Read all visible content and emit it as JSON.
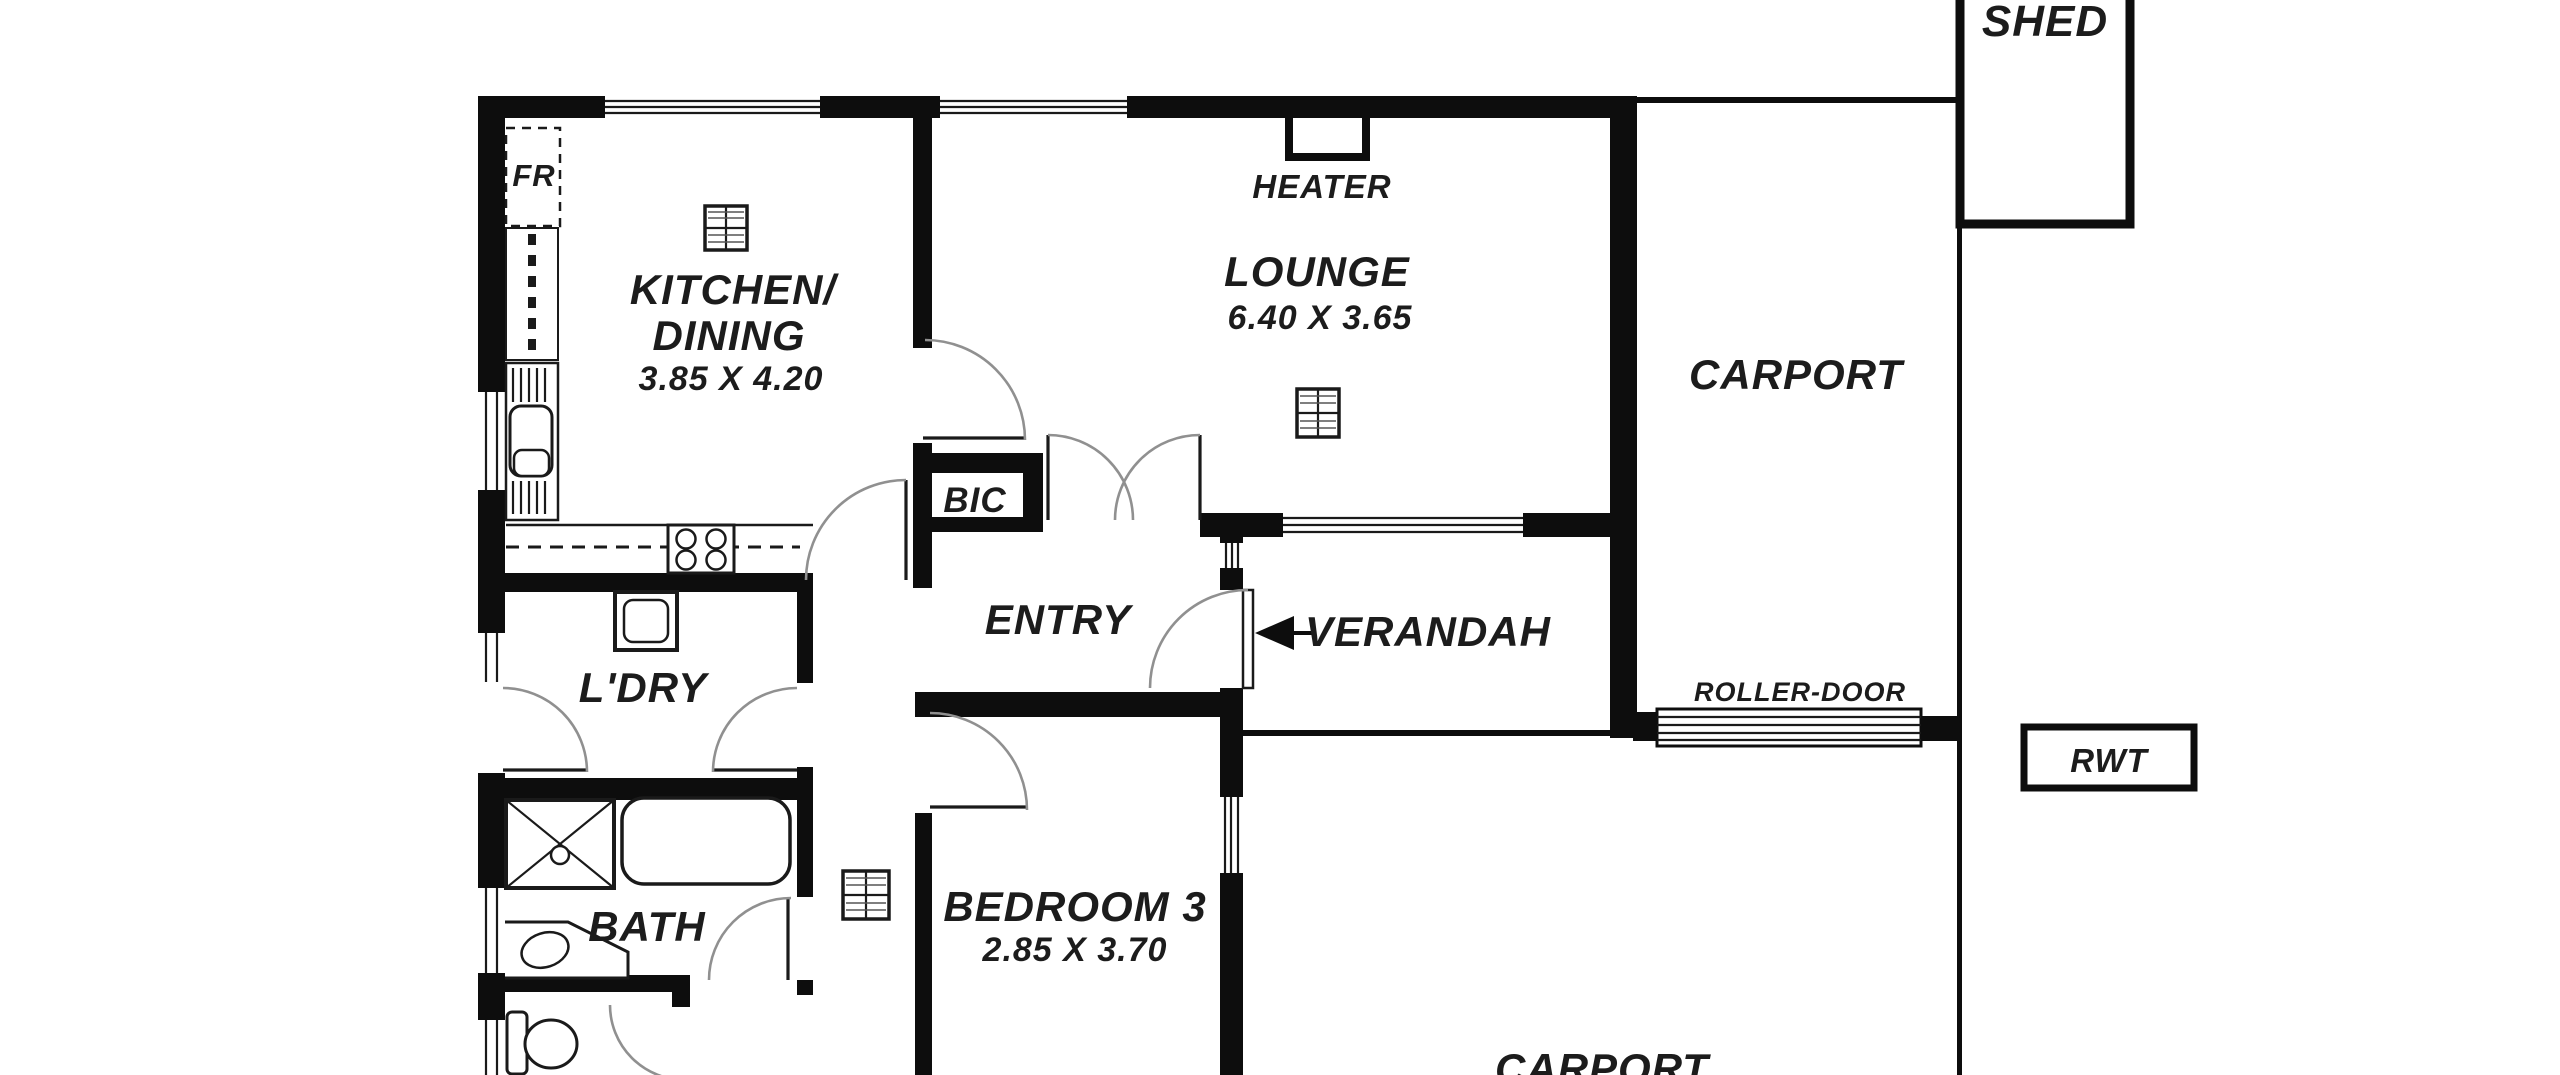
{
  "canvas": {
    "width": 2560,
    "height": 1075,
    "background": "#ffffff"
  },
  "colors": {
    "wall": "#0d0d0d",
    "text": "#1c1c1c",
    "door_arc": "#909090",
    "fixture_stroke": "#1a1a1a",
    "background": "#ffffff"
  },
  "labels": {
    "shed": "SHED",
    "carport_upper": "CARPORT",
    "heater": "HEATER",
    "lounge_name": "LOUNGE",
    "lounge_dims": "6.40 X 3.65",
    "kitchen_name_line1": "KITCHEN/",
    "kitchen_name_line2": "DINING",
    "kitchen_dims": "3.85 X 4.20",
    "fridge": "FR",
    "bic": "BIC",
    "entry": "ENTRY",
    "verandah": "VERANDAH",
    "roller_door": "ROLLER-DOOR",
    "rwt": "RWT",
    "laundry": "L'DRY",
    "bath": "BATH",
    "bedroom3_name": "BEDROOM 3",
    "bedroom3_dims": "2.85 X 3.70",
    "carport_lower": "CARPORT"
  }
}
